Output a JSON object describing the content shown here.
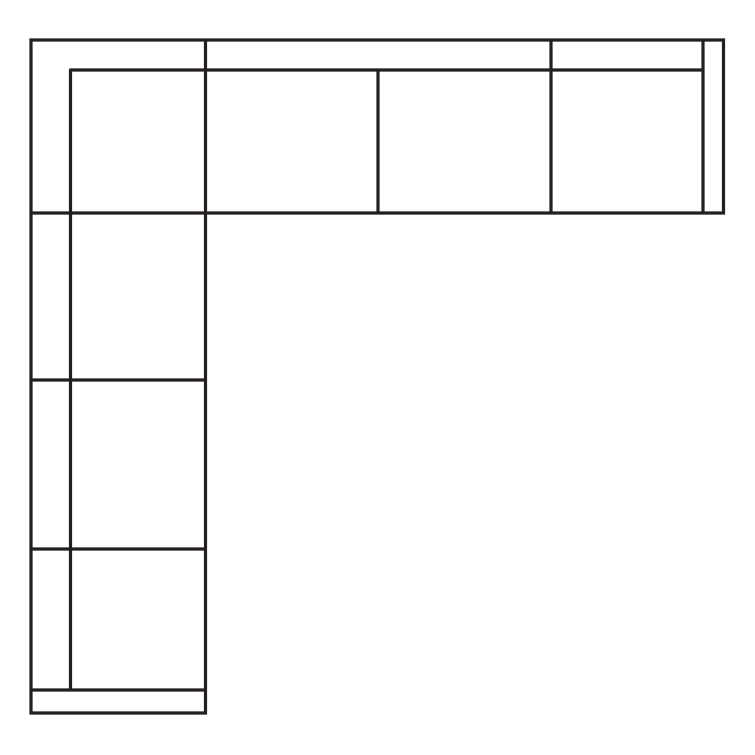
{
  "canvas": {
    "width": 755,
    "height": 755,
    "background_color": "#ffffff"
  },
  "diagram": {
    "name": "l-shaped-sectional-sofa-floor-plan",
    "line_color": "#231f20",
    "line_width": 3.2,
    "outline": {
      "name": "sectional-outer-outline",
      "points": "31,40 723.5,40 723.5,213 205.5,213 205.5,713 31,713"
    },
    "segments": [
      {
        "name": "backrest-line-horizontal",
        "x1": 69.5,
        "y1": 70,
        "x2": 703,
        "y2": 70
      },
      {
        "name": "backrest-line-vertical",
        "x1": 70.5,
        "y1": 69,
        "x2": 70.5,
        "y2": 691
      },
      {
        "name": "top-row-divider-corner",
        "x1": 205.5,
        "y1": 40,
        "x2": 205.5,
        "y2": 213
      },
      {
        "name": "top-row-divider-middle",
        "x1": 378,
        "y1": 70,
        "x2": 378,
        "y2": 213
      },
      {
        "name": "top-row-divider-right",
        "x1": 551,
        "y1": 40,
        "x2": 551,
        "y2": 213
      },
      {
        "name": "right-armrest-line",
        "x1": 703,
        "y1": 40,
        "x2": 703,
        "y2": 213
      },
      {
        "name": "left-column-divider-top",
        "x1": 31,
        "y1": 213,
        "x2": 205.5,
        "y2": 213
      },
      {
        "name": "left-column-divider-middle",
        "x1": 31,
        "y1": 380,
        "x2": 205.5,
        "y2": 380
      },
      {
        "name": "left-column-divider-bottom",
        "x1": 31,
        "y1": 549,
        "x2": 205.5,
        "y2": 549
      },
      {
        "name": "bottom-armrest-line",
        "x1": 31,
        "y1": 690,
        "x2": 205.5,
        "y2": 690
      }
    ]
  }
}
